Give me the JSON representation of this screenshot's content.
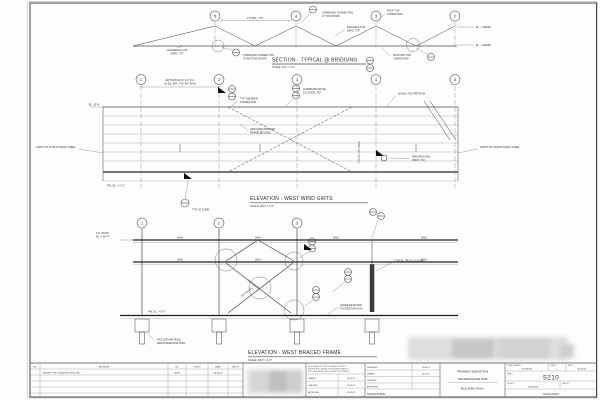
{
  "top_section": {
    "title": "SECTION - TYPICAL @ BRIDGING",
    "scale": "SCALE: 3/4\" = 1'-0\"",
    "bubbles": [
      "5",
      "4",
      "3",
      "2"
    ],
    "callouts": {
      "spa_dim": "2'-6\" SPA., TYP.",
      "top_chord_conn": [
        "X-BRIDGING CONNECTION",
        "AT TOP CHORD"
      ],
      "clip_left": [
        "CLEARANCE CLIP",
        "DAPS, TYP."
      ],
      "clip_right": [
        "DIAGONAL CLIP",
        "DAPS, TYP."
      ],
      "bottom_chord_conn": [
        "X-BRIDGING CONNECTION",
        "TO BOTTOM CHORD"
      ],
      "roof_top": [
        "ROOF TOP",
        "CHORD PEAK"
      ],
      "roof_bottom": [
        "ROOF BOTTOM",
        "CHORD PEAK"
      ],
      "el_high": "EL. + VARIES",
      "el_low": "EL. + VARIES"
    }
  },
  "wind_girts": {
    "title": "ELEVATION - WEST WIND GIRTS",
    "scale": "SCALE: 3/16\" = 1'-0\"",
    "bubbles": [
      "1",
      "2",
      "3",
      "4",
      "5"
    ],
    "callouts": {
      "girt_note": [
        "GIRTS W8x10 AT 4'-0\" O.C.",
        "(3) EQ. SPA., TYP. INT. BAYS"
      ],
      "beam_conn": [
        "TYP. T&B BEAM",
        "CONNECTION"
      ],
      "braced_note": [
        "INDICATES BRACED",
        "FRAME BEYOND"
      ],
      "splice_note": [
        "ALTERNATE SPLICE",
        "LOCATION, TYP."
      ],
      "beam_tag": "W14x26, TAG PER PLAN",
      "sag_note": [
        "INDICATES SAG",
        "RODS, TYP."
      ],
      "limits_left": "LIMITS OF STRUCTURAL STEEL",
      "limits_right": "LIMITS OF STRUCTURAL STEEL",
      "el_top": "EL. 25'-4\"",
      "el_fin": "FIN. EL. = 0'-0\"",
      "curb_note": "TYP. AT CURB",
      "bays_note": "TYP. ALL INT. BAYS"
    }
  },
  "braced_frame": {
    "title": "ELEVATION - WEST BRACED FRAME",
    "scale": "SCALE: 3/16\" = 1'-0\"",
    "bubbles": [
      "1",
      "2",
      "3"
    ],
    "beam_label": "W14",
    "brace_label": "HSS 8x8x3/8",
    "callouts": {
      "tos": [
        "T.O. ROOF",
        "EL. = 25'-4\""
      ],
      "fin_el": "FIN. EL. = 0'-0\"",
      "truss_col": "TYPICAL TRUSS COLUMN",
      "grade_beam": [
        "GRADE BEAM PER",
        "FOUNDATION PLAN"
      ],
      "pile_cap": [
        "PILE CAP AND PILES",
        "PER FOUNDATION PLAN"
      ]
    }
  },
  "titlebar": {
    "revisions": {
      "headers": [
        "NO.",
        "REVISION",
        "BY",
        "CHK'D",
        "DATE",
        "APP'D"
      ],
      "row1": {
        "no": "-",
        "desc": "ISSUED FOR CONSTRUCTION - BID",
        "by": "MJW",
        "date": "05-05-11"
      }
    },
    "approval": {
      "note": [
        "ACCEPTANCE OF THIS DOCUMENT DOES NOT",
        "RELIEVE THE CONTRACTOR OF RESPONSIBILITY",
        "FOR COMPLIANCE WITH CONTRACT DOCUMENTS"
      ],
      "rows": [
        {
          "label": "DRAWN",
          "date": "05-05-11"
        },
        {
          "label": "CHECKED",
          "date": "05-05-11"
        },
        {
          "label": "APPROVED",
          "date": "05-05-11"
        }
      ]
    },
    "signoff": {
      "rows": [
        {
          "label": "DESIGNED",
          "value": "05-05-11"
        },
        {
          "label": "DRAWN",
          "value": "05-05-11"
        },
        {
          "label": "CHECKED",
          "value": ""
        },
        {
          "label": "APPROVED",
          "value": ""
        }
      ],
      "discipline": "STRUCTURAL"
    },
    "title_block": {
      "line1": "FRAMING ELEVATION",
      "line2": "THE WAREHOUSE PARK",
      "line3": "BUILDING 04-61"
    },
    "sheet_box": {
      "comm_label": "COMM. NUMBER",
      "comm": "W-582476",
      "scale_label": "SCALE",
      "scale_val": "-",
      "date_label": "DATE",
      "date": "05-05-11",
      "sheet_label": "SHEET",
      "sheet": "S210",
      "cad_label": "CAD NO.",
      "cad": "W-826782",
      "dwg_label": "DWG NO.",
      "dwg": "04-00-S210"
    }
  }
}
